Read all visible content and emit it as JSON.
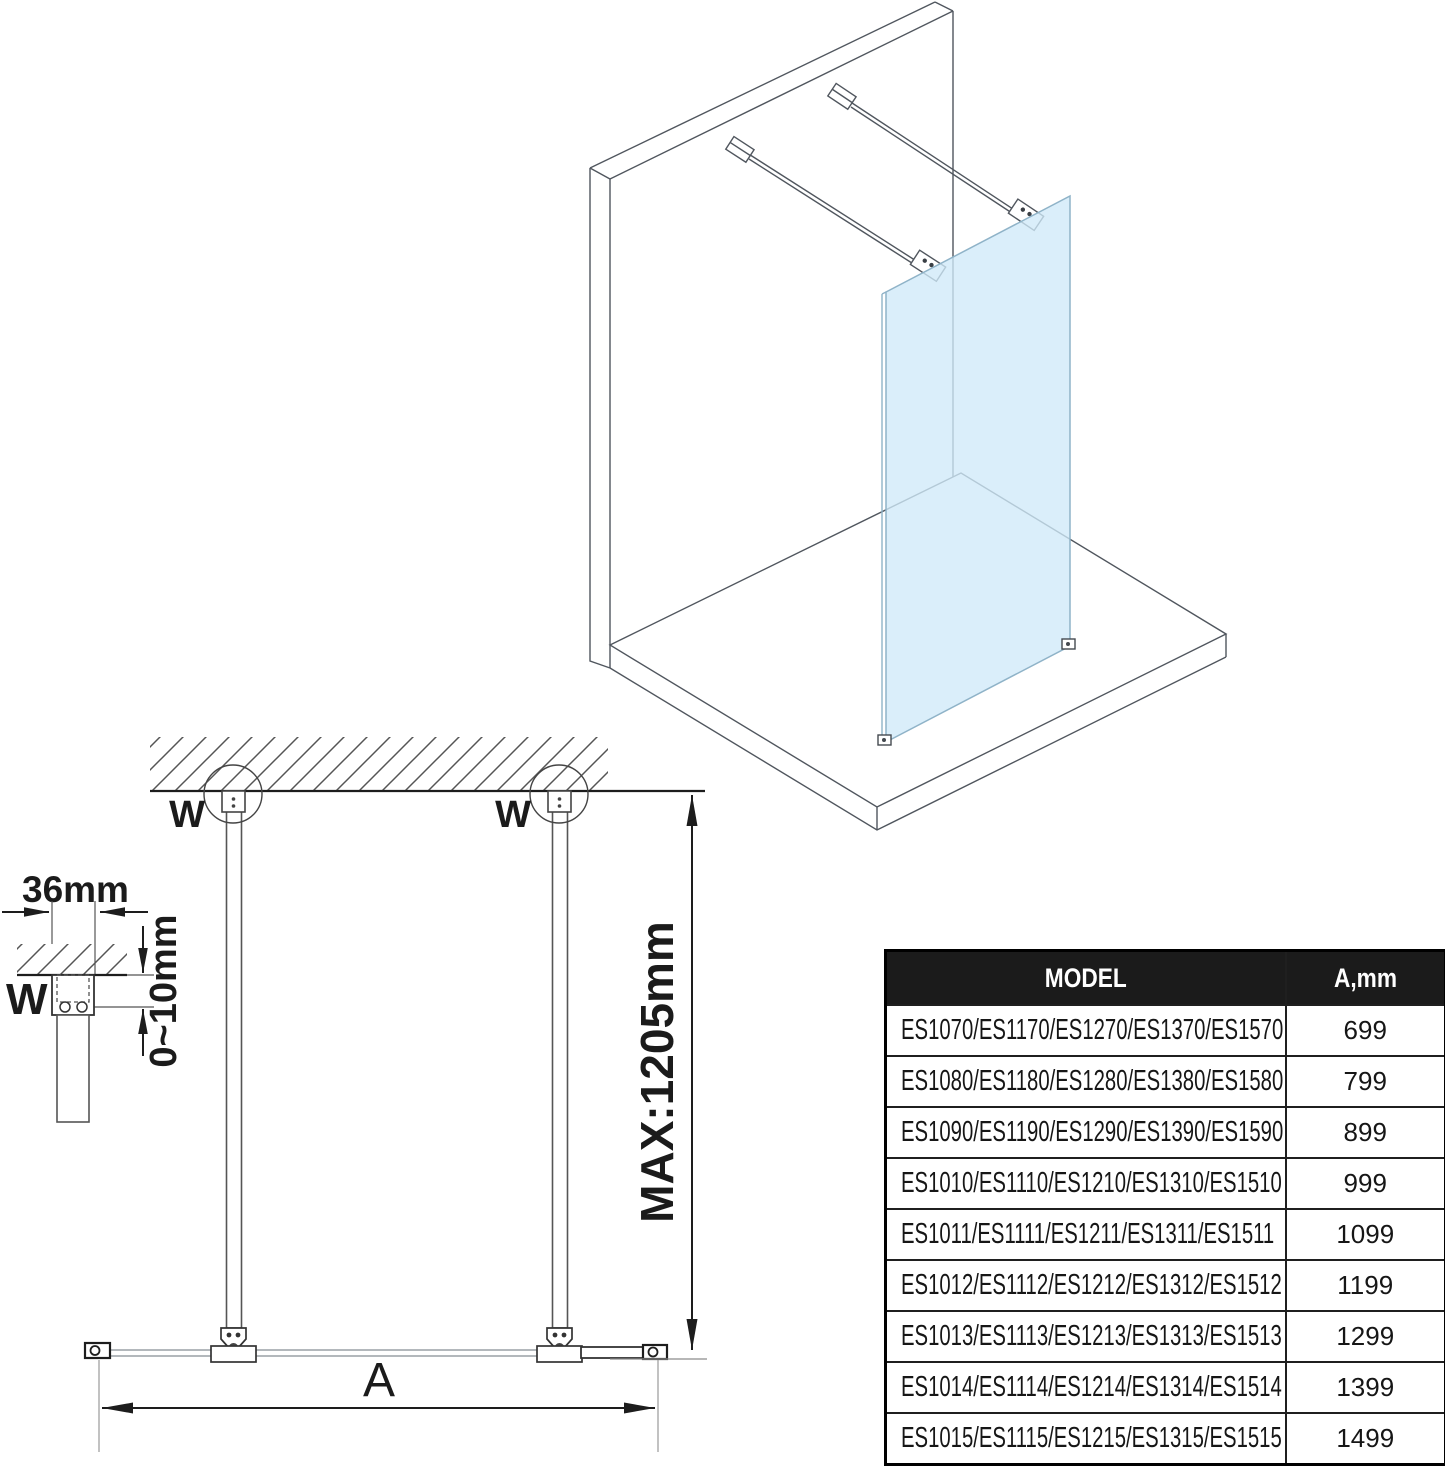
{
  "colors": {
    "glass": "#cfe9f8",
    "glass_edge": "#8fb3c8",
    "iso_line": "#50565e",
    "dim_line": "#222222"
  },
  "plan": {
    "w_left": "W",
    "w_right": "W",
    "max_label": "MAX:1205mm",
    "a_label": "A"
  },
  "detail": {
    "width_label": "36mm",
    "gap_label": "0~10mm",
    "w_label": "W"
  },
  "table": {
    "headers": {
      "model": "MODEL",
      "a": "A,mm"
    },
    "rows": [
      {
        "model": "ES1070/ES1170/ES1270/ES1370/ES1570",
        "a": "699"
      },
      {
        "model": "ES1080/ES1180/ES1280/ES1380/ES1580",
        "a": "799"
      },
      {
        "model": "ES1090/ES1190/ES1290/ES1390/ES1590",
        "a": "899"
      },
      {
        "model": "ES1010/ES1110/ES1210/ES1310/ES1510",
        "a": "999"
      },
      {
        "model": "ES1011/ES1111/ES1211/ES1311/ES1511",
        "a": "1099"
      },
      {
        "model": "ES1012/ES1112/ES1212/ES1312/ES1512",
        "a": "1199"
      },
      {
        "model": "ES1013/ES1113/ES1213/ES1313/ES1513",
        "a": "1299"
      },
      {
        "model": "ES1014/ES1114/ES1214/ES1314/ES1514",
        "a": "1399"
      },
      {
        "model": "ES1015/ES1115/ES1215/ES1315/ES1515",
        "a": "1499"
      }
    ]
  }
}
